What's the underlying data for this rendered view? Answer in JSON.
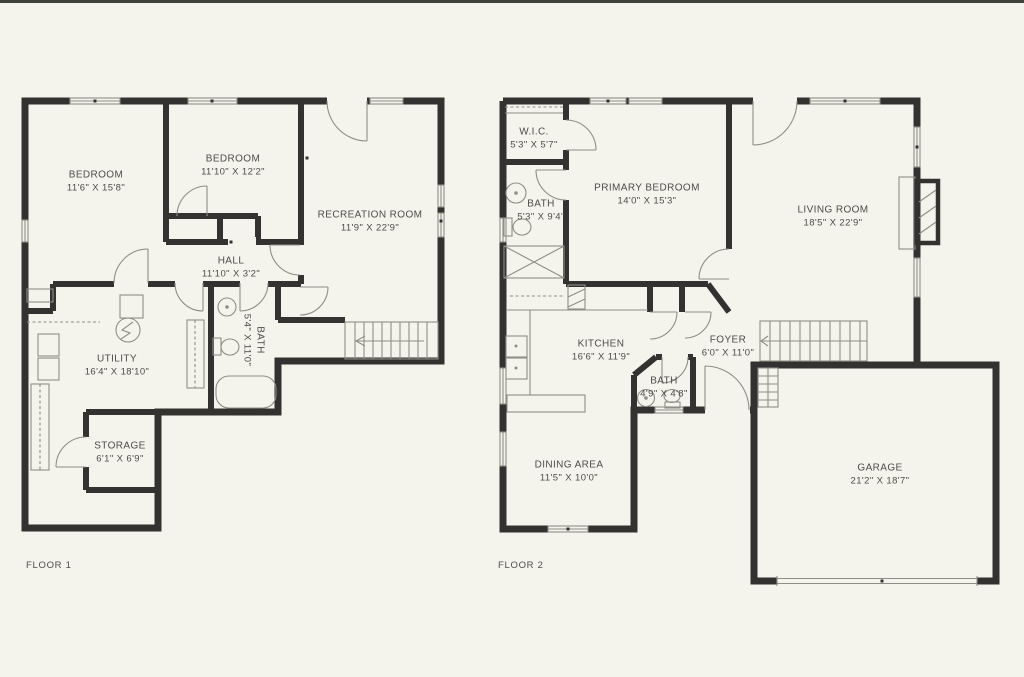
{
  "meta": {
    "background_color": "#f4f4ec",
    "wall_color": "#333230",
    "detail_line_color": "#8e8e86",
    "text_color": "#4d4d48",
    "top_bar_color": "#3f413b"
  },
  "floor1": {
    "label": "FLOOR 1",
    "rooms": {
      "bedroom1": {
        "name": "BEDROOM",
        "dims": "11'6\" X 15'8\""
      },
      "bedroom2": {
        "name": "BEDROOM",
        "dims": "11'10\" X 12'2\""
      },
      "recreation": {
        "name": "RECREATION ROOM",
        "dims": "11'9\" X 22'9\""
      },
      "hall": {
        "name": "HALL",
        "dims": "11'10\" X 3'2\""
      },
      "bath": {
        "name": "BATH",
        "dims": "5'4\" X 11'0\""
      },
      "utility": {
        "name": "UTILITY",
        "dims": "16'4\" X 18'10\""
      },
      "storage": {
        "name": "STORAGE",
        "dims": "6'1\" X 6'9\""
      }
    }
  },
  "floor2": {
    "label": "FLOOR 2",
    "rooms": {
      "wic": {
        "name": "W.I.C.",
        "dims": "5'3\" X 5'7\""
      },
      "bath1": {
        "name": "BATH",
        "dims": "5'3\" X 9'4\""
      },
      "primary": {
        "name": "PRIMARY BEDROOM",
        "dims": "14'0\" X 15'3\""
      },
      "living": {
        "name": "LIVING ROOM",
        "dims": "18'5\" X 22'9\""
      },
      "kitchen": {
        "name": "KITCHEN",
        "dims": "16'6\" X 11'9\""
      },
      "foyer": {
        "name": "FOYER",
        "dims": "6'0\" X 11'0\""
      },
      "bath2": {
        "name": "BATH",
        "dims": "4'9\" X 4'8\""
      },
      "dining": {
        "name": "DINING AREA",
        "dims": "11'5\" X 10'0\""
      },
      "garage": {
        "name": "GARAGE",
        "dims": "21'2\" X 18'7\""
      }
    }
  }
}
